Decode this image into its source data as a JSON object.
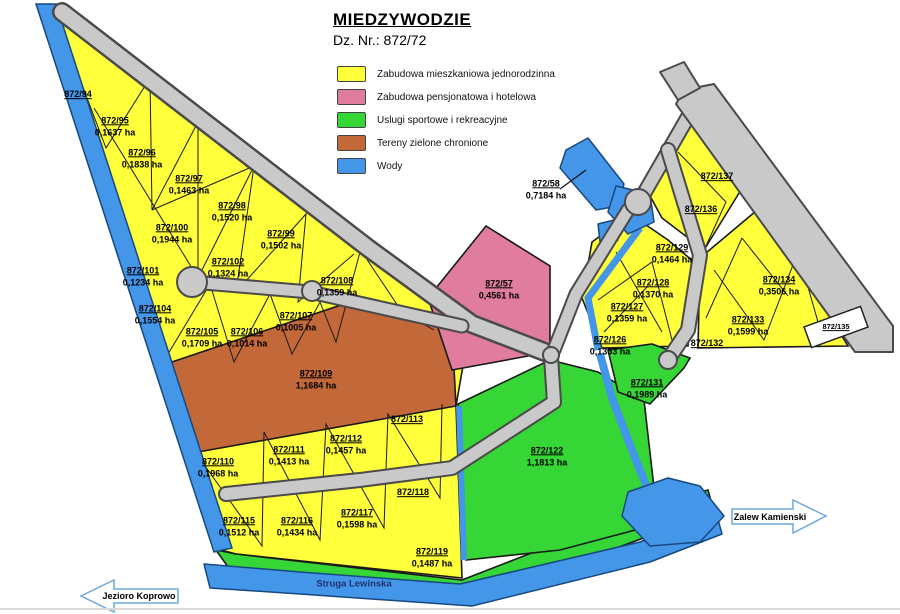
{
  "title": {
    "main": "MIEDZYWODZIE",
    "subtitle": "Dz. Nr.: 872/72"
  },
  "legend": [
    {
      "label": "Zabudowa mieszkaniowa jednorodzinna",
      "color": "#FFFF3C"
    },
    {
      "label": "Zabudowa pensjonatowa i hotelowa",
      "color": "#E07D9E"
    },
    {
      "label": "Uslugi sportowe i rekreacyjne",
      "color": "#35D635"
    },
    {
      "label": "Tereny zielone chronione",
      "color": "#C26839"
    },
    {
      "label": "Wody",
      "color": "#4496E8"
    }
  ],
  "colors": {
    "residential": "#FFFF3C",
    "hotel": "#E07D9E",
    "sport": "#35D635",
    "green_protected": "#C26839",
    "water": "#4496E8",
    "road": "#C9C9C9",
    "road_edge": "#4A4A4A"
  },
  "water_features": {
    "stream_label": "Struga Lewinska"
  },
  "direction_arrows": [
    {
      "label": "Jezioro Koprowo",
      "direction": "left"
    },
    {
      "label": "Zalew Kamienski",
      "direction": "right"
    }
  ],
  "parcels": [
    {
      "id": "872/94",
      "area": "",
      "x": 78,
      "y": 95,
      "type": "residential"
    },
    {
      "id": "872/95",
      "area": "0,1637 ha",
      "x": 115,
      "y": 127,
      "type": "residential"
    },
    {
      "id": "872/96",
      "area": "0,1838 ha",
      "x": 142,
      "y": 159,
      "type": "residential"
    },
    {
      "id": "872/97",
      "area": "0,1463 ha",
      "x": 189,
      "y": 185,
      "type": "residential"
    },
    {
      "id": "872/98",
      "area": "0,1520 ha",
      "x": 232,
      "y": 212,
      "type": "residential"
    },
    {
      "id": "872/99",
      "area": "0,1502 ha",
      "x": 281,
      "y": 240,
      "type": "residential"
    },
    {
      "id": "872/100",
      "area": "0,1944 ha",
      "x": 172,
      "y": 234,
      "type": "residential"
    },
    {
      "id": "872/101",
      "area": "0,1234 ha",
      "x": 143,
      "y": 277,
      "type": "residential"
    },
    {
      "id": "872/102",
      "area": "0,1324 ha",
      "x": 228,
      "y": 268,
      "type": "residential"
    },
    {
      "id": "872/104",
      "area": "0,1554 ha",
      "x": 155,
      "y": 315,
      "type": "residential"
    },
    {
      "id": "872/105",
      "area": "0,1709 ha",
      "x": 202,
      "y": 338,
      "type": "residential"
    },
    {
      "id": "872/106",
      "area": "0,1014 ha",
      "x": 247,
      "y": 338,
      "type": "residential"
    },
    {
      "id": "872/107",
      "area": "0,1005 ha",
      "x": 296,
      "y": 322,
      "type": "residential"
    },
    {
      "id": "872/108",
      "area": "0,1359 ha",
      "x": 337,
      "y": 287,
      "type": "residential"
    },
    {
      "id": "872/109",
      "area": "1,1684 ha",
      "x": 316,
      "y": 380,
      "type": "green_protected"
    },
    {
      "id": "872/110",
      "area": "0,1968 ha",
      "x": 218,
      "y": 468,
      "type": "residential"
    },
    {
      "id": "872/111",
      "area": "0,1413 ha",
      "x": 289,
      "y": 456,
      "type": "residential"
    },
    {
      "id": "872/112",
      "area": "0,1457 ha",
      "x": 346,
      "y": 445,
      "type": "residential"
    },
    {
      "id": "872/113",
      "area": "",
      "x": 407,
      "y": 420,
      "type": "residential"
    },
    {
      "id": "872/115",
      "area": "0,1512 ha",
      "x": 239,
      "y": 527,
      "type": "residential"
    },
    {
      "id": "872/116",
      "area": "0,1434 ha",
      "x": 297,
      "y": 527,
      "type": "residential"
    },
    {
      "id": "872/117",
      "area": "0,1598 ha",
      "x": 357,
      "y": 519,
      "type": "residential"
    },
    {
      "id": "872/118",
      "area": "",
      "x": 413,
      "y": 493,
      "type": "residential"
    },
    {
      "id": "872/119",
      "area": "0,1487 ha",
      "x": 432,
      "y": 558,
      "type": "residential"
    },
    {
      "id": "872/122",
      "area": "1,1813 ha",
      "x": 547,
      "y": 457,
      "type": "sport"
    },
    {
      "id": "872/126",
      "area": "0,1353 ha",
      "x": 610,
      "y": 346,
      "type": "residential"
    },
    {
      "id": "872/127",
      "area": "0,1359 ha",
      "x": 627,
      "y": 313,
      "type": "residential"
    },
    {
      "id": "872/128",
      "area": "0,1370 ha",
      "x": 653,
      "y": 289,
      "type": "residential"
    },
    {
      "id": "872/129",
      "area": "0,1464 ha",
      "x": 672,
      "y": 254,
      "type": "residential"
    },
    {
      "id": "872/131",
      "area": "0,1989 ha",
      "x": 647,
      "y": 389,
      "type": "sport"
    },
    {
      "id": "872/132",
      "area": "",
      "x": 707,
      "y": 344,
      "type": "residential"
    },
    {
      "id": "872/133",
      "area": "0,1599 ha",
      "x": 748,
      "y": 326,
      "type": "residential"
    },
    {
      "id": "872/134",
      "area": "0,3506 ha",
      "x": 779,
      "y": 286,
      "type": "residential"
    },
    {
      "id": "872/135",
      "area": "",
      "x": 836,
      "y": 327,
      "type": "other"
    },
    {
      "id": "872/136",
      "area": "",
      "x": 701,
      "y": 210,
      "type": "residential"
    },
    {
      "id": "872/137",
      "area": "",
      "x": 717,
      "y": 177,
      "type": "residential"
    },
    {
      "id": "872/57",
      "area": "0,4561 ha",
      "x": 499,
      "y": 290,
      "type": "hotel"
    },
    {
      "id": "872/58",
      "area": "0,7184 ha",
      "x": 546,
      "y": 190,
      "type": "water"
    }
  ]
}
